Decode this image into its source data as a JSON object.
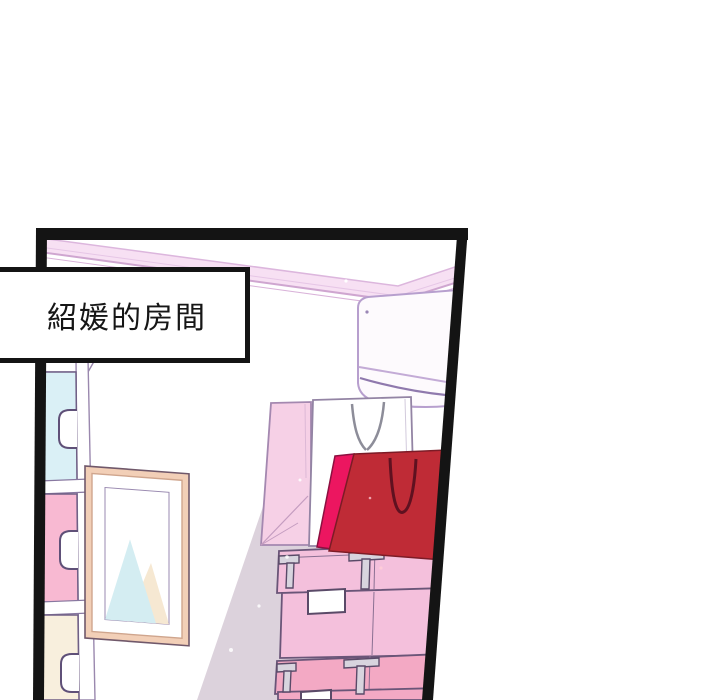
{
  "caption": {
    "text": "紹媛的房間"
  },
  "colors": {
    "panel_border": "#141414",
    "background": "#ffffff",
    "ceiling_trim": "#f7e0f3",
    "ceiling_line": "#d9aed9",
    "wall_shadow": "#dcd2dc",
    "ac_body": "#fdfafd",
    "drawer_cyan": "#daf0f6",
    "drawer_pink": "#f8b9d2",
    "drawer_cream": "#f8efdd",
    "dresser_white": "#ffffff",
    "frame_wood": "#f2cfb7",
    "frame_mat": "#ffffff",
    "art_triangle_cyan": "#d4edf2",
    "art_triangle_cream": "#f6e8d2",
    "bag_pink": "#f6d0e6",
    "bag_white": "#ffffff",
    "bag_red": "#bf2b36",
    "bag_magenta": "#ec1660",
    "box_top_pink": "#f4c0dc",
    "box_bottom_pink": "#f3a9c4",
    "box_clip_gray": "#d8d4de",
    "label_white": "#ffffff"
  },
  "scene_objects": [
    "room-panel",
    "caption-box",
    "ceiling-trim",
    "air-conditioner",
    "dresser",
    "picture-frame",
    "wall-shadow",
    "shopping-bag-pink",
    "shopping-bag-white",
    "shopping-bag-red",
    "storage-box-top",
    "storage-box-bottom"
  ]
}
